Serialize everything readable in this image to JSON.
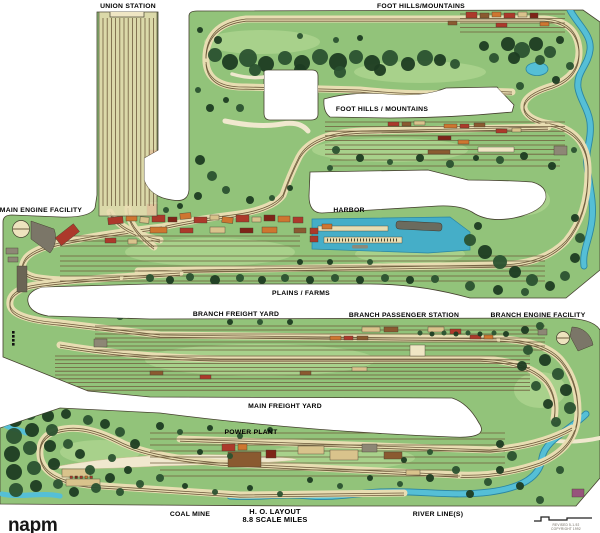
{
  "region_labels": {
    "union_station": "UNION STATION",
    "foothills_top": "FOOT HILLS/MOUNTAINS",
    "foothills_mid": "FOOT HILLS / MOUNTAINS",
    "main_engine_facility": "MAIN ENGINE FACILITY",
    "harbor": "HARBOR",
    "plains_farms": "PLAINS / FARMS",
    "branch_freight_yard": "BRANCH FREIGHT YARD",
    "branch_passenger_station": "BRANCH PASSENGER STATION",
    "branch_engine_facility": "BRANCH ENGINE FACILITY",
    "main_freight_yard": "MAIN FREIGHT YARD",
    "power_plant": "POWER PLANT",
    "coal_mine": "COAL MINE",
    "river_lines": "RIVER LINE(S)"
  },
  "title_block": {
    "line1": "H. O. LAYOUT",
    "line2": "8.8 SCALE MILES"
  },
  "logo": "napm",
  "fine_print": {
    "line1": "REVISED 5-1-92",
    "line2": "COPYRIGHT 1992"
  },
  "palette": {
    "grass": "#92C37A",
    "grass_light": "#B7DB96",
    "tree_dark": "#1E3C22",
    "tree_mid": "#2B5230",
    "roadbed_tan": "#E8DDB2",
    "rail_brown": "#6F5C3D",
    "water": "#4FB6CE",
    "water_edge": "#2B86A2",
    "building_red": "#AC392B",
    "building_dark_red": "#7E2418",
    "building_orange": "#CE7630",
    "building_tan": "#D9C38C",
    "building_gray": "#8D8775",
    "ink_outline": "#45402F"
  }
}
